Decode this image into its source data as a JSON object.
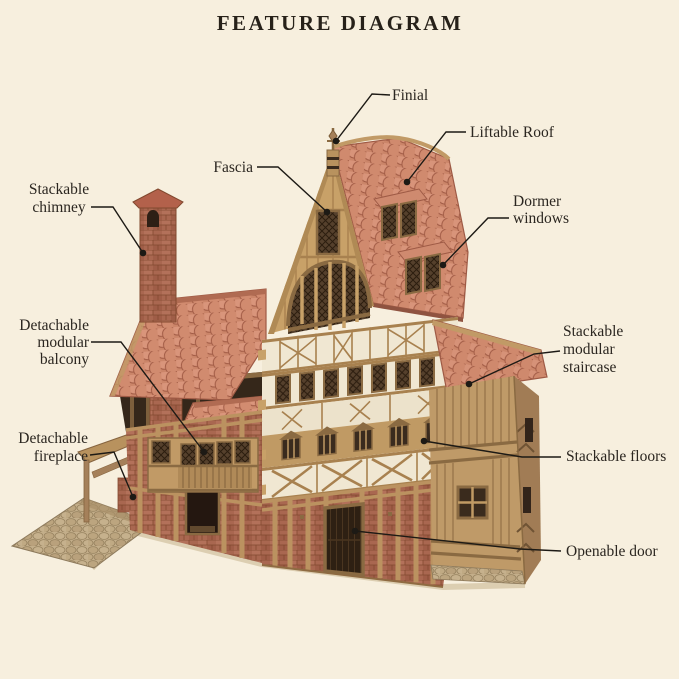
{
  "title": "FEATURE DIAGRAM",
  "labels": {
    "finial": [
      "Finial"
    ],
    "liftable_roof": [
      "Liftable Roof"
    ],
    "fascia": [
      "Fascia"
    ],
    "stackable_chimney": [
      "Stackable",
      "chimney"
    ],
    "dormer_windows": [
      "Dormer",
      "windows"
    ],
    "stackable_modular_staircase": [
      "Stackable",
      "modular",
      "staircase"
    ],
    "stackable_floors": [
      "Stackable floors"
    ],
    "openable_door": [
      "Openable door"
    ],
    "detachable_modular_balcony": [
      "Detachable",
      "modular",
      "balcony"
    ],
    "detachable_fireplace": [
      "Detachable",
      "fireplace"
    ]
  },
  "colors": {
    "background": "#f7efde",
    "text": "#2b2620",
    "leader_line": "#1d1a15",
    "roof_tile": "#d18a70",
    "roof_tile_shadow": "#a15b45",
    "wood": "#c5a069",
    "wood_dark": "#8a6a42",
    "plaster": "#f0e7d2",
    "brick": "#a96750",
    "lattice_window": "#55402c",
    "cobblestone": "#c3ae8a"
  }
}
